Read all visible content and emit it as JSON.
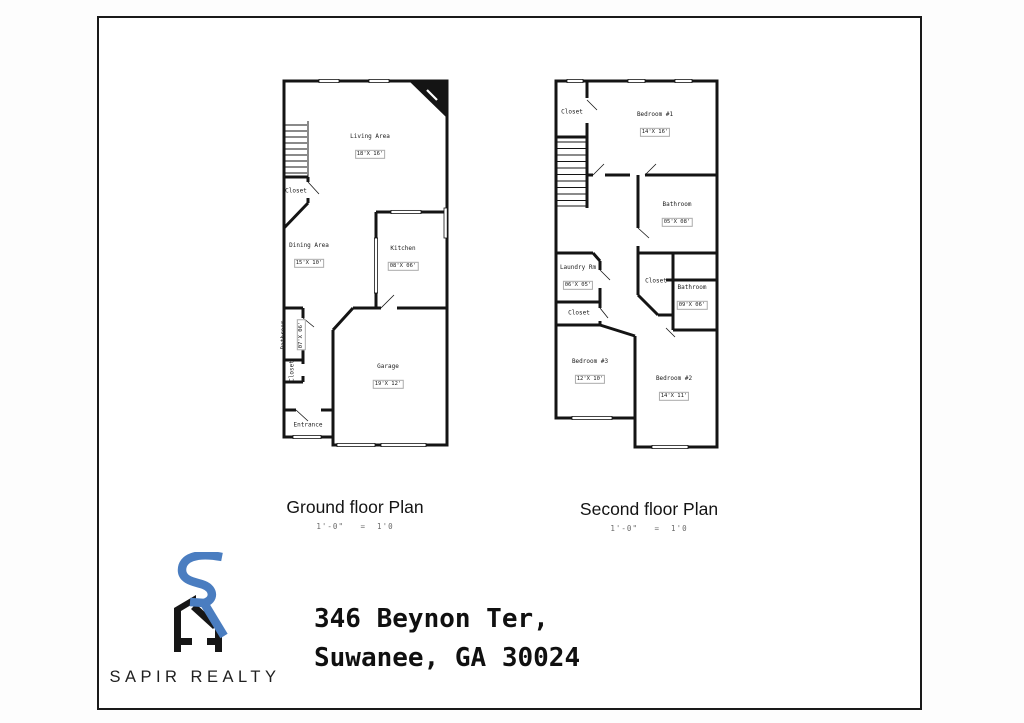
{
  "frame": {
    "border_color": "#1a1a1a"
  },
  "plans": {
    "ground": {
      "title": "Ground floor Plan",
      "scale": "1'-0\"   =  1'0",
      "rooms": [
        {
          "name": "Living Area",
          "dims": "18'X 16'"
        },
        {
          "name": "Dining Area",
          "dims": "15'X 10'"
        },
        {
          "name": "Kitchen",
          "dims": "08'X 06'"
        },
        {
          "name": "Bathroom",
          "dims": "07'X 06'"
        },
        {
          "name": "Closet"
        },
        {
          "name": "Closet"
        },
        {
          "name": "Garage",
          "dims": "19'X 12'"
        },
        {
          "name": "Entrance"
        }
      ]
    },
    "second": {
      "title": "Second floor Plan",
      "scale": "1'-0\"   =  1'0",
      "rooms": [
        {
          "name": "Closet"
        },
        {
          "name": "Bedroom #1",
          "dims": "14'X 16'"
        },
        {
          "name": "Bathroom",
          "dims": "05'X 08'"
        },
        {
          "name": "Laundry Rm",
          "dims": "06'X 05'"
        },
        {
          "name": "Closet"
        },
        {
          "name": "Bathroom",
          "dims": "09'X 06'"
        },
        {
          "name": "Closet"
        },
        {
          "name": "Bedroom #3",
          "dims": "12'X 10'"
        },
        {
          "name": "Bedroom #2",
          "dims": "14'X 11'"
        }
      ]
    }
  },
  "address": {
    "line1": "346 Beynon Ter,",
    "line2": "Suwanee, GA 30024"
  },
  "logo": {
    "text": "SAPIR REALTY",
    "monogram": "sr-house-monogram",
    "blue": "#4a7dc0",
    "black": "#161616"
  }
}
